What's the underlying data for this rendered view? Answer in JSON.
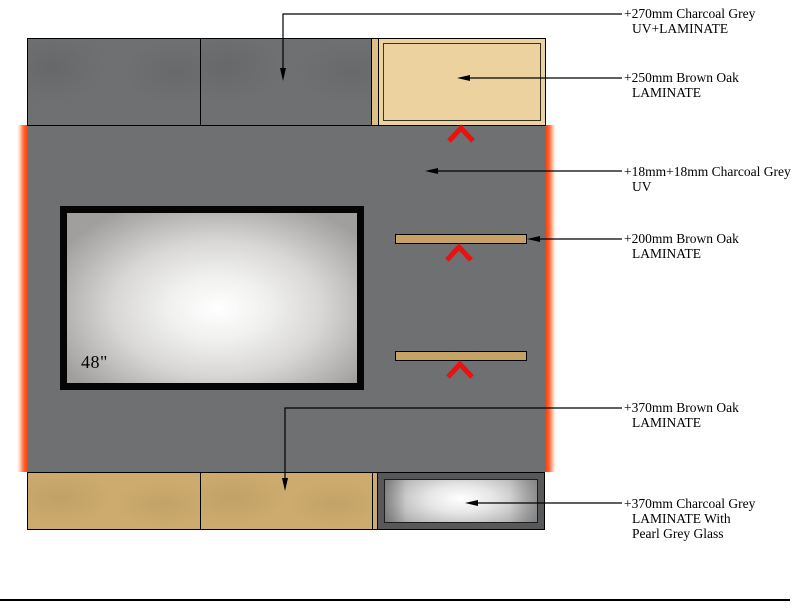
{
  "drawing": {
    "tv": {
      "size_label": "48\""
    },
    "annotations": [
      {
        "lines": [
          "+270mm Charcoal Grey",
          "UV+LAMINATE"
        ]
      },
      {
        "lines": [
          "+250mm Brown Oak",
          "LAMINATE"
        ]
      },
      {
        "lines": [
          "+18mm+18mm Charcoal Grey",
          "UV"
        ]
      },
      {
        "lines": [
          "+200mm Brown Oak",
          "LAMINATE"
        ]
      },
      {
        "lines": [
          "+370mm Brown Oak",
          "LAMINATE"
        ]
      },
      {
        "lines": [
          "+370mm Charcoal Grey",
          "LAMINATE With",
          "Pearl Grey Glass"
        ]
      }
    ],
    "icons": {
      "chevron_up": "^",
      "arrow_left": "◀",
      "arrow_down": "▼"
    },
    "colors": {
      "charcoal_grey": "#6e7072",
      "brown_oak_light": "#ecd29e",
      "brown_oak_dark": "#cdab6e",
      "shelf_oak": "#c6a265",
      "led_glow_orange": "#ff4512",
      "chevron_red": "#ea1211",
      "tv_frame_black": "#050505",
      "glass_frame_grey": "#57585a",
      "line_black": "#000000"
    }
  }
}
